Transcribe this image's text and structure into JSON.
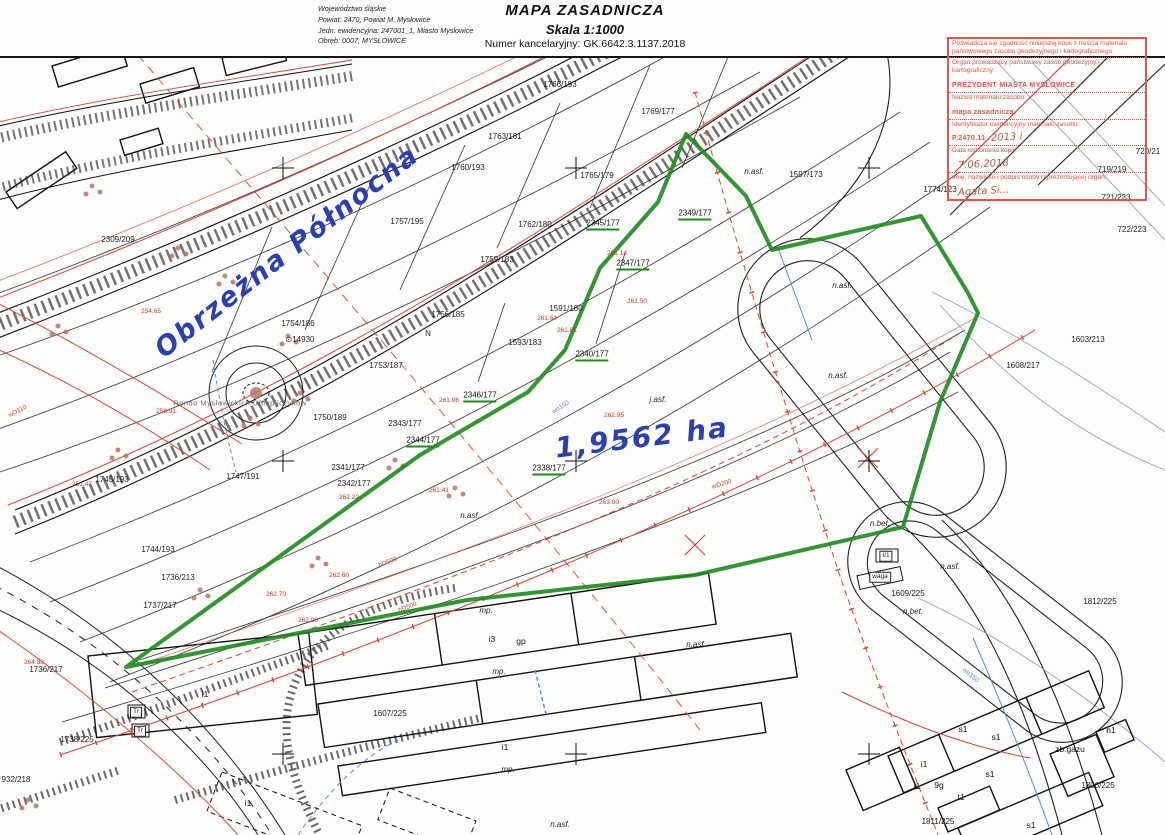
{
  "header": {
    "left": [
      "Województwo śląskie",
      "Powiat: 2470, Powiat M. Mysłowice",
      "Jedn. ewidencyjna: 247001_1, Miasto Mysłowice",
      "Obręb: 0007, MYSŁOWICE"
    ],
    "title": "MAPA ZASADNICZA",
    "scale": "Skala 1:1000",
    "kancelaryjny": "Numer kancelaryjny: GK.6642.3.1137.2018"
  },
  "stamp": {
    "rows": [
      {
        "label": "Poświadcza się zgodność niniejszej kopii z treścią materiału państwowego zasobu geodezyjnego i kartograficznego"
      },
      {
        "label": "Organ prowadzący państwowy zasób geodezyjny i kartograficzny:",
        "value": "PREZYDENT MIASTA MYSŁOWICE"
      },
      {
        "label": "Nazwa materiału zasobu:",
        "value": "mapa zasadnicza"
      },
      {
        "label": "Identyfikator ewidencyjny materiału zasobu:",
        "value": "P.2470.11",
        "hand": "2013 i"
      },
      {
        "label": "Data wykonania kopii:",
        "hand": "7.06.2018"
      },
      {
        "label": "Imię, nazwisko i podpis osoby reprezentującej organ:",
        "hand": "Agata Si..."
      }
    ]
  },
  "annotations": {
    "street": "Obrzeżna Północna",
    "area": "1,9562 ha"
  },
  "map": {
    "labels": [
      {
        "t": "2309/209",
        "x": 118,
        "y": 240
      },
      {
        "t": "1766/193",
        "x": 560,
        "y": 85
      },
      {
        "t": "1769/177",
        "x": 658,
        "y": 112
      },
      {
        "t": "1763/181",
        "x": 505,
        "y": 137
      },
      {
        "t": "1760/193",
        "x": 468,
        "y": 168
      },
      {
        "t": "1757/195",
        "x": 407,
        "y": 222
      },
      {
        "t": "1762/180",
        "x": 535,
        "y": 225
      },
      {
        "t": "1759/183",
        "x": 497,
        "y": 260
      },
      {
        "t": "1765/179",
        "x": 597,
        "y": 176
      },
      {
        "t": "1756/185",
        "x": 448,
        "y": 315
      },
      {
        "t": "N",
        "x": 428,
        "y": 334
      },
      {
        "t": "1754/186",
        "x": 298,
        "y": 324
      },
      {
        "t": "⊙14930",
        "x": 300,
        "y": 340
      },
      {
        "t": "1753/187",
        "x": 386,
        "y": 366
      },
      {
        "t": "1750/189",
        "x": 330,
        "y": 418
      },
      {
        "t": "1591/180",
        "x": 566,
        "y": 309
      },
      {
        "t": "1593/183",
        "x": 525,
        "y": 343
      },
      {
        "t": "1747/191",
        "x": 243,
        "y": 477
      },
      {
        "t": "1745/193",
        "x": 112,
        "y": 480
      },
      {
        "t": "1744/193",
        "x": 158,
        "y": 550
      },
      {
        "t": "1736/213",
        "x": 178,
        "y": 578
      },
      {
        "t": "1737/217",
        "x": 160,
        "y": 606
      },
      {
        "t": "1736/217",
        "x": 46,
        "y": 670
      },
      {
        "t": "1738/225",
        "x": 77,
        "y": 740
      },
      {
        "t": "932/218",
        "x": 16,
        "y": 780
      },
      {
        "t": "1597/173",
        "x": 806,
        "y": 175
      },
      {
        "t": "1774/123",
        "x": 940,
        "y": 190
      },
      {
        "t": "719/219",
        "x": 1112,
        "y": 170
      },
      {
        "t": "720/21",
        "x": 1148,
        "y": 152
      },
      {
        "t": "721/223",
        "x": 1116,
        "y": 198
      },
      {
        "t": "722/223",
        "x": 1132,
        "y": 230
      },
      {
        "t": "1603/213",
        "x": 1088,
        "y": 340
      },
      {
        "t": "1608/217",
        "x": 1023,
        "y": 366
      },
      {
        "t": "1609/225",
        "x": 908,
        "y": 594
      },
      {
        "t": "1812/225",
        "x": 1100,
        "y": 602
      },
      {
        "t": "1806/225",
        "x": 1098,
        "y": 786
      },
      {
        "t": "1811/225",
        "x": 938,
        "y": 822
      },
      {
        "t": "1607/225",
        "x": 390,
        "y": 714
      },
      {
        "t": "2343/177",
        "x": 405,
        "y": 424
      },
      {
        "t": "2341/177",
        "x": 348,
        "y": 468
      },
      {
        "t": "2342/177",
        "x": 354,
        "y": 484
      },
      {
        "t": "2349/177",
        "x": 695,
        "y": 215,
        "c": "pg"
      },
      {
        "t": "2347/177",
        "x": 633,
        "y": 265,
        "c": "pg"
      },
      {
        "t": "2345/177",
        "x": 603,
        "y": 225,
        "c": "pg"
      },
      {
        "t": "2340/177",
        "x": 592,
        "y": 356,
        "c": "pg"
      },
      {
        "t": "2346/177",
        "x": 480,
        "y": 397,
        "c": "pg"
      },
      {
        "t": "2344/177",
        "x": 423,
        "y": 442,
        "c": "pg"
      },
      {
        "t": "2338/177",
        "x": 549,
        "y": 470,
        "c": "pg"
      },
      {
        "t": "n.asf.",
        "x": 754,
        "y": 172,
        "c": "s"
      },
      {
        "t": "n.asf.",
        "x": 842,
        "y": 286,
        "c": "s"
      },
      {
        "t": "n.asf.",
        "x": 838,
        "y": 376,
        "c": "s"
      },
      {
        "t": "n.asf.",
        "x": 470,
        "y": 516,
        "c": "s"
      },
      {
        "t": "n.asf.",
        "x": 696,
        "y": 645,
        "c": "s"
      },
      {
        "t": "n.asf.",
        "x": 950,
        "y": 567,
        "c": "s"
      },
      {
        "t": "n.asf.",
        "x": 560,
        "y": 825,
        "c": "s"
      },
      {
        "t": "j.asf.",
        "x": 658,
        "y": 400,
        "c": "s"
      },
      {
        "t": "n.bet.",
        "x": 880,
        "y": 524,
        "c": "s"
      },
      {
        "t": "n.bet.",
        "x": 913,
        "y": 612,
        "c": "s"
      },
      {
        "t": "mp.",
        "x": 486,
        "y": 611,
        "c": "s"
      },
      {
        "t": "mp.",
        "x": 499,
        "y": 672,
        "c": "s"
      },
      {
        "t": "mp.",
        "x": 508,
        "y": 770,
        "c": "s"
      },
      {
        "t": "i3",
        "x": 492,
        "y": 639,
        "c": "b"
      },
      {
        "t": "gp",
        "x": 521,
        "y": 641,
        "c": "b"
      },
      {
        "t": "i1",
        "x": 505,
        "y": 747,
        "c": "b"
      },
      {
        "t": "i1",
        "x": 205,
        "y": 694,
        "c": "b"
      },
      {
        "t": "i1",
        "x": 248,
        "y": 803,
        "c": "b"
      },
      {
        "t": "i1",
        "x": 924,
        "y": 764,
        "c": "b"
      },
      {
        "t": "i1",
        "x": 917,
        "y": 786,
        "c": "b"
      },
      {
        "t": "s1",
        "x": 963,
        "y": 729,
        "c": "b"
      },
      {
        "t": "s1",
        "x": 996,
        "y": 737,
        "c": "b"
      },
      {
        "t": "s1",
        "x": 990,
        "y": 774,
        "c": "b"
      },
      {
        "t": "s1",
        "x": 1031,
        "y": 825,
        "c": "b"
      },
      {
        "t": "t1",
        "x": 961,
        "y": 797,
        "c": "b"
      },
      {
        "t": "9g",
        "x": 939,
        "y": 785,
        "c": "b"
      },
      {
        "t": "h1",
        "x": 1111,
        "y": 730,
        "c": "b"
      },
      {
        "t": "zb.gazu",
        "x": 1070,
        "y": 749,
        "c": "b"
      },
      {
        "t": "waga",
        "x": 880,
        "y": 577,
        "c": "box"
      },
      {
        "t": "I/1",
        "x": 886,
        "y": 556,
        "c": "box"
      },
      {
        "t": "Tr",
        "x": 136,
        "y": 712,
        "c": "box"
      },
      {
        "t": "Tr",
        "x": 140,
        "y": 731,
        "c": "box"
      },
      {
        "t": "261.14",
        "x": 617,
        "y": 254,
        "c": "e"
      },
      {
        "t": "261.50",
        "x": 637,
        "y": 302,
        "c": "e"
      },
      {
        "t": "261.61",
        "x": 567,
        "y": 331,
        "c": "e"
      },
      {
        "t": "261.64",
        "x": 547,
        "y": 319,
        "c": "e"
      },
      {
        "t": "261.96",
        "x": 449,
        "y": 401,
        "c": "e"
      },
      {
        "t": "262.22",
        "x": 349,
        "y": 498,
        "c": "e"
      },
      {
        "t": "261.41",
        "x": 439,
        "y": 491,
        "c": "e"
      },
      {
        "t": "262.95",
        "x": 614,
        "y": 416,
        "c": "e"
      },
      {
        "t": "263.00",
        "x": 609,
        "y": 503,
        "c": "e"
      },
      {
        "t": "262.60",
        "x": 339,
        "y": 576,
        "c": "e"
      },
      {
        "t": "262.70",
        "x": 276,
        "y": 595,
        "c": "e"
      },
      {
        "t": "262.90",
        "x": 308,
        "y": 621,
        "c": "e"
      },
      {
        "t": "254.65",
        "x": 151,
        "y": 312,
        "c": "e"
      },
      {
        "t": "258.91",
        "x": 166,
        "y": 412,
        "c": "e"
      },
      {
        "t": "251.47",
        "x": 82,
        "y": 485,
        "c": "e"
      },
      {
        "t": "264.88",
        "x": 34,
        "y": 663,
        "c": "e"
      },
      {
        "t": "hD500",
        "x": 388,
        "y": 563,
        "c": "u",
        "r": -22
      },
      {
        "t": "hD500",
        "x": 408,
        "y": 608,
        "c": "u",
        "r": -22
      },
      {
        "t": "wD200",
        "x": 722,
        "y": 485,
        "c": "u",
        "r": -18
      },
      {
        "t": "wD110",
        "x": 18,
        "y": 412,
        "c": "u",
        "r": -28
      },
      {
        "t": "wo160",
        "x": 561,
        "y": 408,
        "c": "ub",
        "r": -33
      },
      {
        "t": "wo150",
        "x": 970,
        "y": 676,
        "c": "ub",
        "r": 40
      },
      {
        "t": "Rondo Mysłowickich Olimpijczyków",
        "x": 240,
        "y": 403,
        "c": "gray"
      },
      {
        "t": "6580204",
        "x": 1126,
        "y": 42,
        "c": "t6"
      },
      {
        "t": "6.129.30.10.2, 6.129.31",
        "x": 1034,
        "y": 57,
        "c": "t6"
      },
      {
        "t": "Obrzeżna Północna",
        "x": 287,
        "y": 252,
        "c": "hand",
        "r": -38,
        "fs": 27,
        "n": "street-name-annotation"
      },
      {
        "t": "1,9562 ha",
        "x": 642,
        "y": 438,
        "c": "hand",
        "r": -7,
        "fs": 28,
        "n": "area-annotation"
      }
    ]
  },
  "colors": {
    "boundary_green": "#1d8a1d",
    "utility_red": "#cd4a3d",
    "water_blue": "#5b8bd0",
    "handwriting_blue": "#2b3fae",
    "stamp_red": "#e2574c"
  }
}
